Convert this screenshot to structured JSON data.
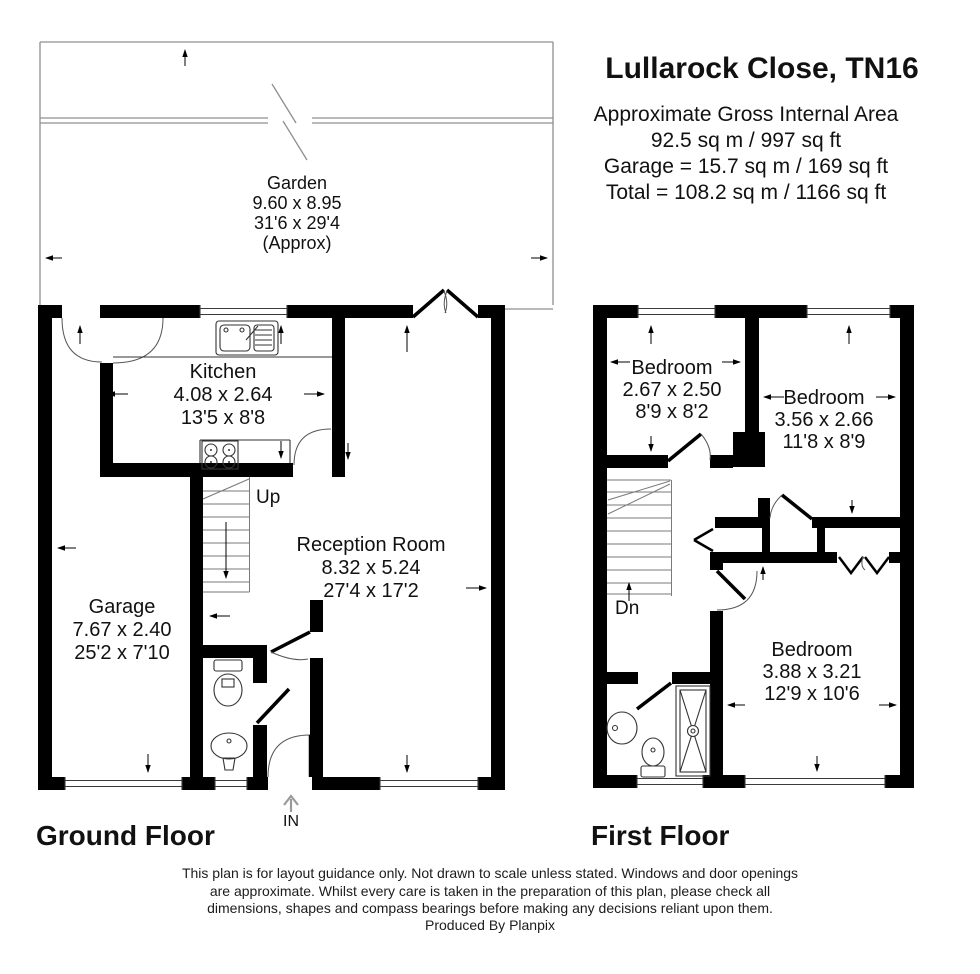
{
  "header": {
    "title": "Lullarock Close, TN16",
    "area_line1": "Approximate Gross Internal Area",
    "area_line2": "92.5 sq m / 997 sq ft",
    "area_line3": "Garage =  15.7 sq m / 169 sq ft",
    "area_line4": "Total = 108.2 sq m / 1166 sq ft"
  },
  "ground_floor": {
    "floor_label": "Ground Floor",
    "garden": {
      "name": "Garden",
      "metric": "9.60 x 8.95",
      "imperial": "31'6 x 29'4",
      "note": "(Approx)"
    },
    "kitchen": {
      "name": "Kitchen",
      "metric": "4.08 x 2.64",
      "imperial": "13'5 x 8'8"
    },
    "reception": {
      "name": "Reception Room",
      "metric": "8.32 x 5.24",
      "imperial": "27'4 x 17'2"
    },
    "garage": {
      "name": "Garage",
      "metric": "7.67 x 2.40",
      "imperial": "25'2 x 7'10"
    },
    "stairs_label": "Up",
    "entrance_label": "IN"
  },
  "first_floor": {
    "floor_label": "First Floor",
    "bedroom1": {
      "name": "Bedroom",
      "metric": "2.67 x 2.50",
      "imperial": "8'9 x 8'2"
    },
    "bedroom2": {
      "name": "Bedroom",
      "metric": "3.56 x 2.66",
      "imperial": "11'8 x 8'9"
    },
    "bedroom3": {
      "name": "Bedroom",
      "metric": "3.88 x 3.21",
      "imperial": "12'9 x 10'6"
    },
    "stairs_label": "Dn"
  },
  "footer": {
    "disclaimer_line1": "This plan is for layout guidance only. Not drawn to scale unless stated. Windows and door openings",
    "disclaimer_line2": "are approximate. Whilst every care is taken in the preparation of this plan, please check all",
    "disclaimer_line3": "dimensions, shapes and compass bearings before making any decisions reliant upon them.",
    "disclaimer_line4": "Produced By Planpix"
  },
  "colors": {
    "wall": "#000000",
    "detail_line": "#444444",
    "garden_line": "#8f8f8f",
    "text": "#111111",
    "background": "#ffffff"
  }
}
